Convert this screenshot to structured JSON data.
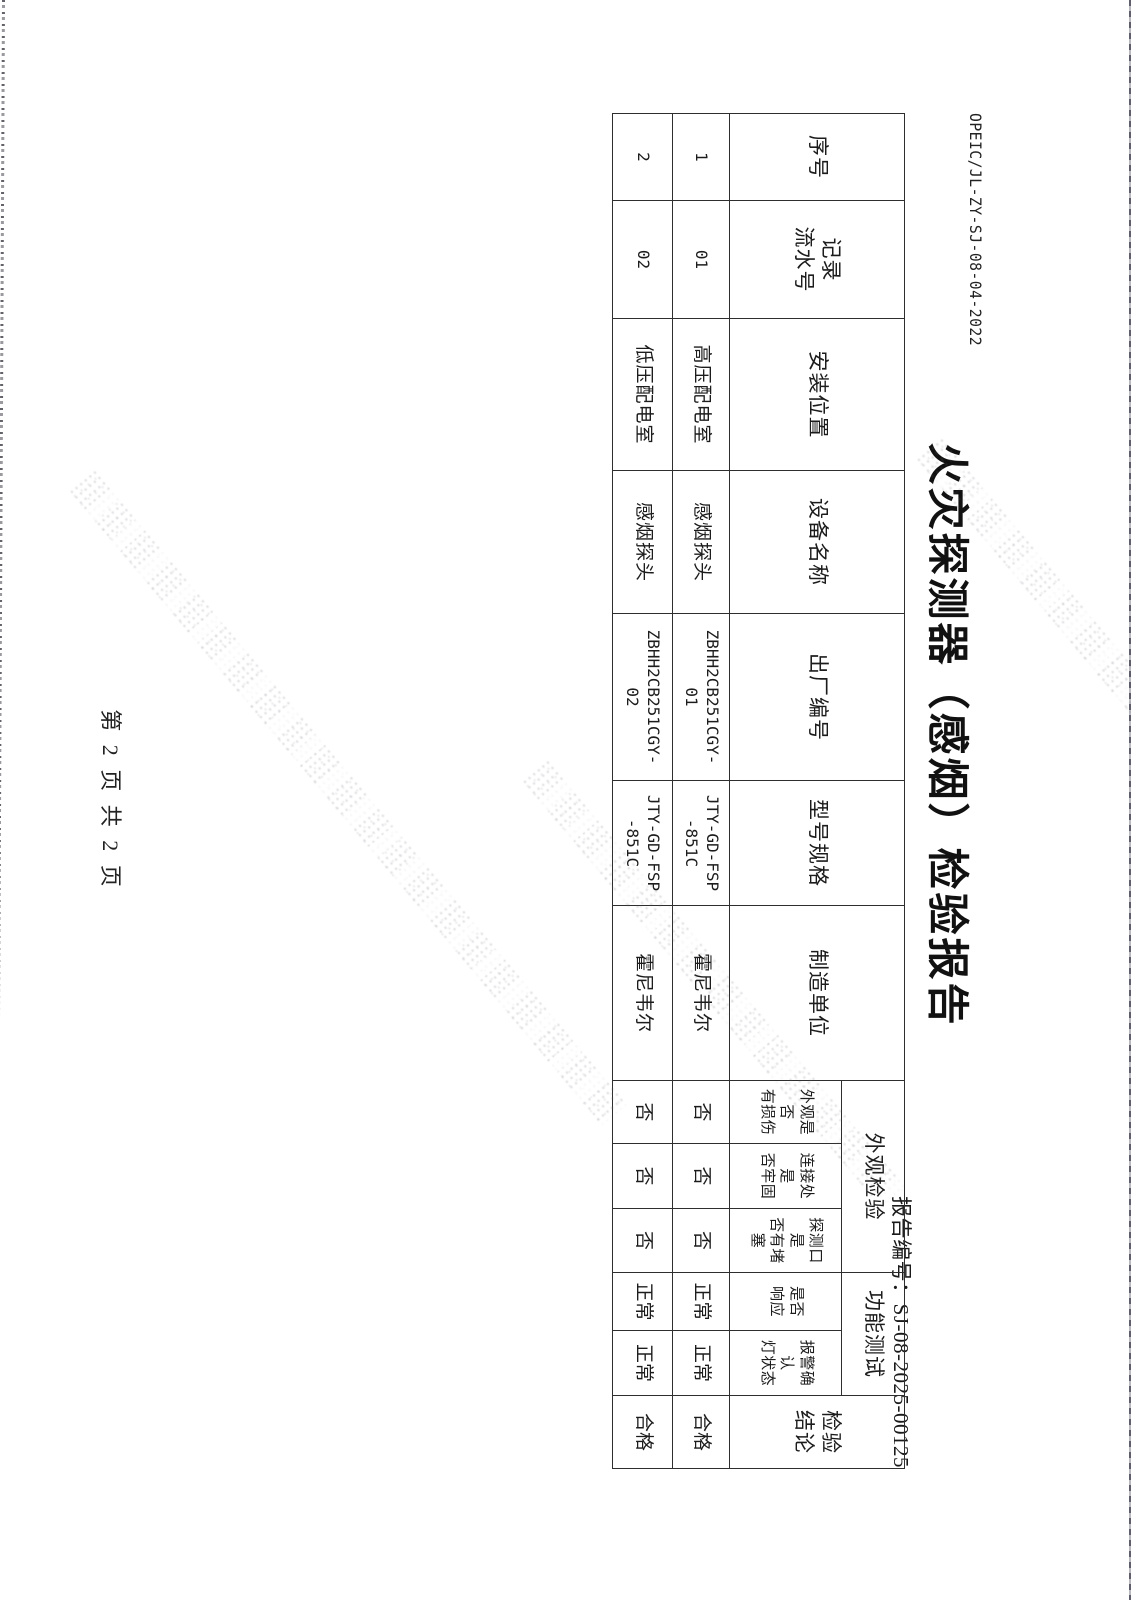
{
  "page": {
    "doc_code": "OPEIC/JL-ZY-SJ-08-04-2022",
    "title": "火灾探测器（感烟）检验报告",
    "report_no": "报告编号：SJ-08-2025-00125",
    "footer": "第 2 页 共 2 页"
  },
  "table": {
    "header": {
      "seq": "序号",
      "record_no": "记录\n流水号",
      "install_location": "安装位置",
      "device_name": "设备名称",
      "factory_no": "出厂编号",
      "model_spec": "型号规格",
      "manufacturer": "制造单位",
      "appearance_group": "外观检验",
      "function_group": "功能测试",
      "conclusion": "检验\n结论",
      "sub_appearance_damage": "外观是否\n有损伤",
      "sub_connection_firm": "连接处是\n否牢固",
      "sub_port_blocked": "探测口是\n否有堵塞",
      "sub_response": "是否\n响应",
      "sub_alarm_light": "报警确认\n灯状态"
    },
    "rows": [
      {
        "cells": [
          "1",
          "01",
          "高压配电室",
          "感烟探头",
          "ZBHH2CB251CGY-\n01",
          "JTY-GD-FSP\n-851C",
          "霍尼韦尔",
          "否",
          "否",
          "否",
          "正常",
          "正常",
          "合格"
        ]
      },
      {
        "cells": [
          "2",
          "02",
          "低压配电室",
          "感烟探头",
          "ZBHH2CB251CGY-\n02",
          "JTY-GD-FSP\n-851C",
          "霍尼韦尔",
          "否",
          "否",
          "否",
          "正常",
          "正常",
          "合格"
        ]
      }
    ]
  },
  "watermark": {
    "present": true,
    "description": "faint dotted diagonal stamp lines, text illegible"
  },
  "orientation": {
    "content_rotation_deg": 90
  }
}
